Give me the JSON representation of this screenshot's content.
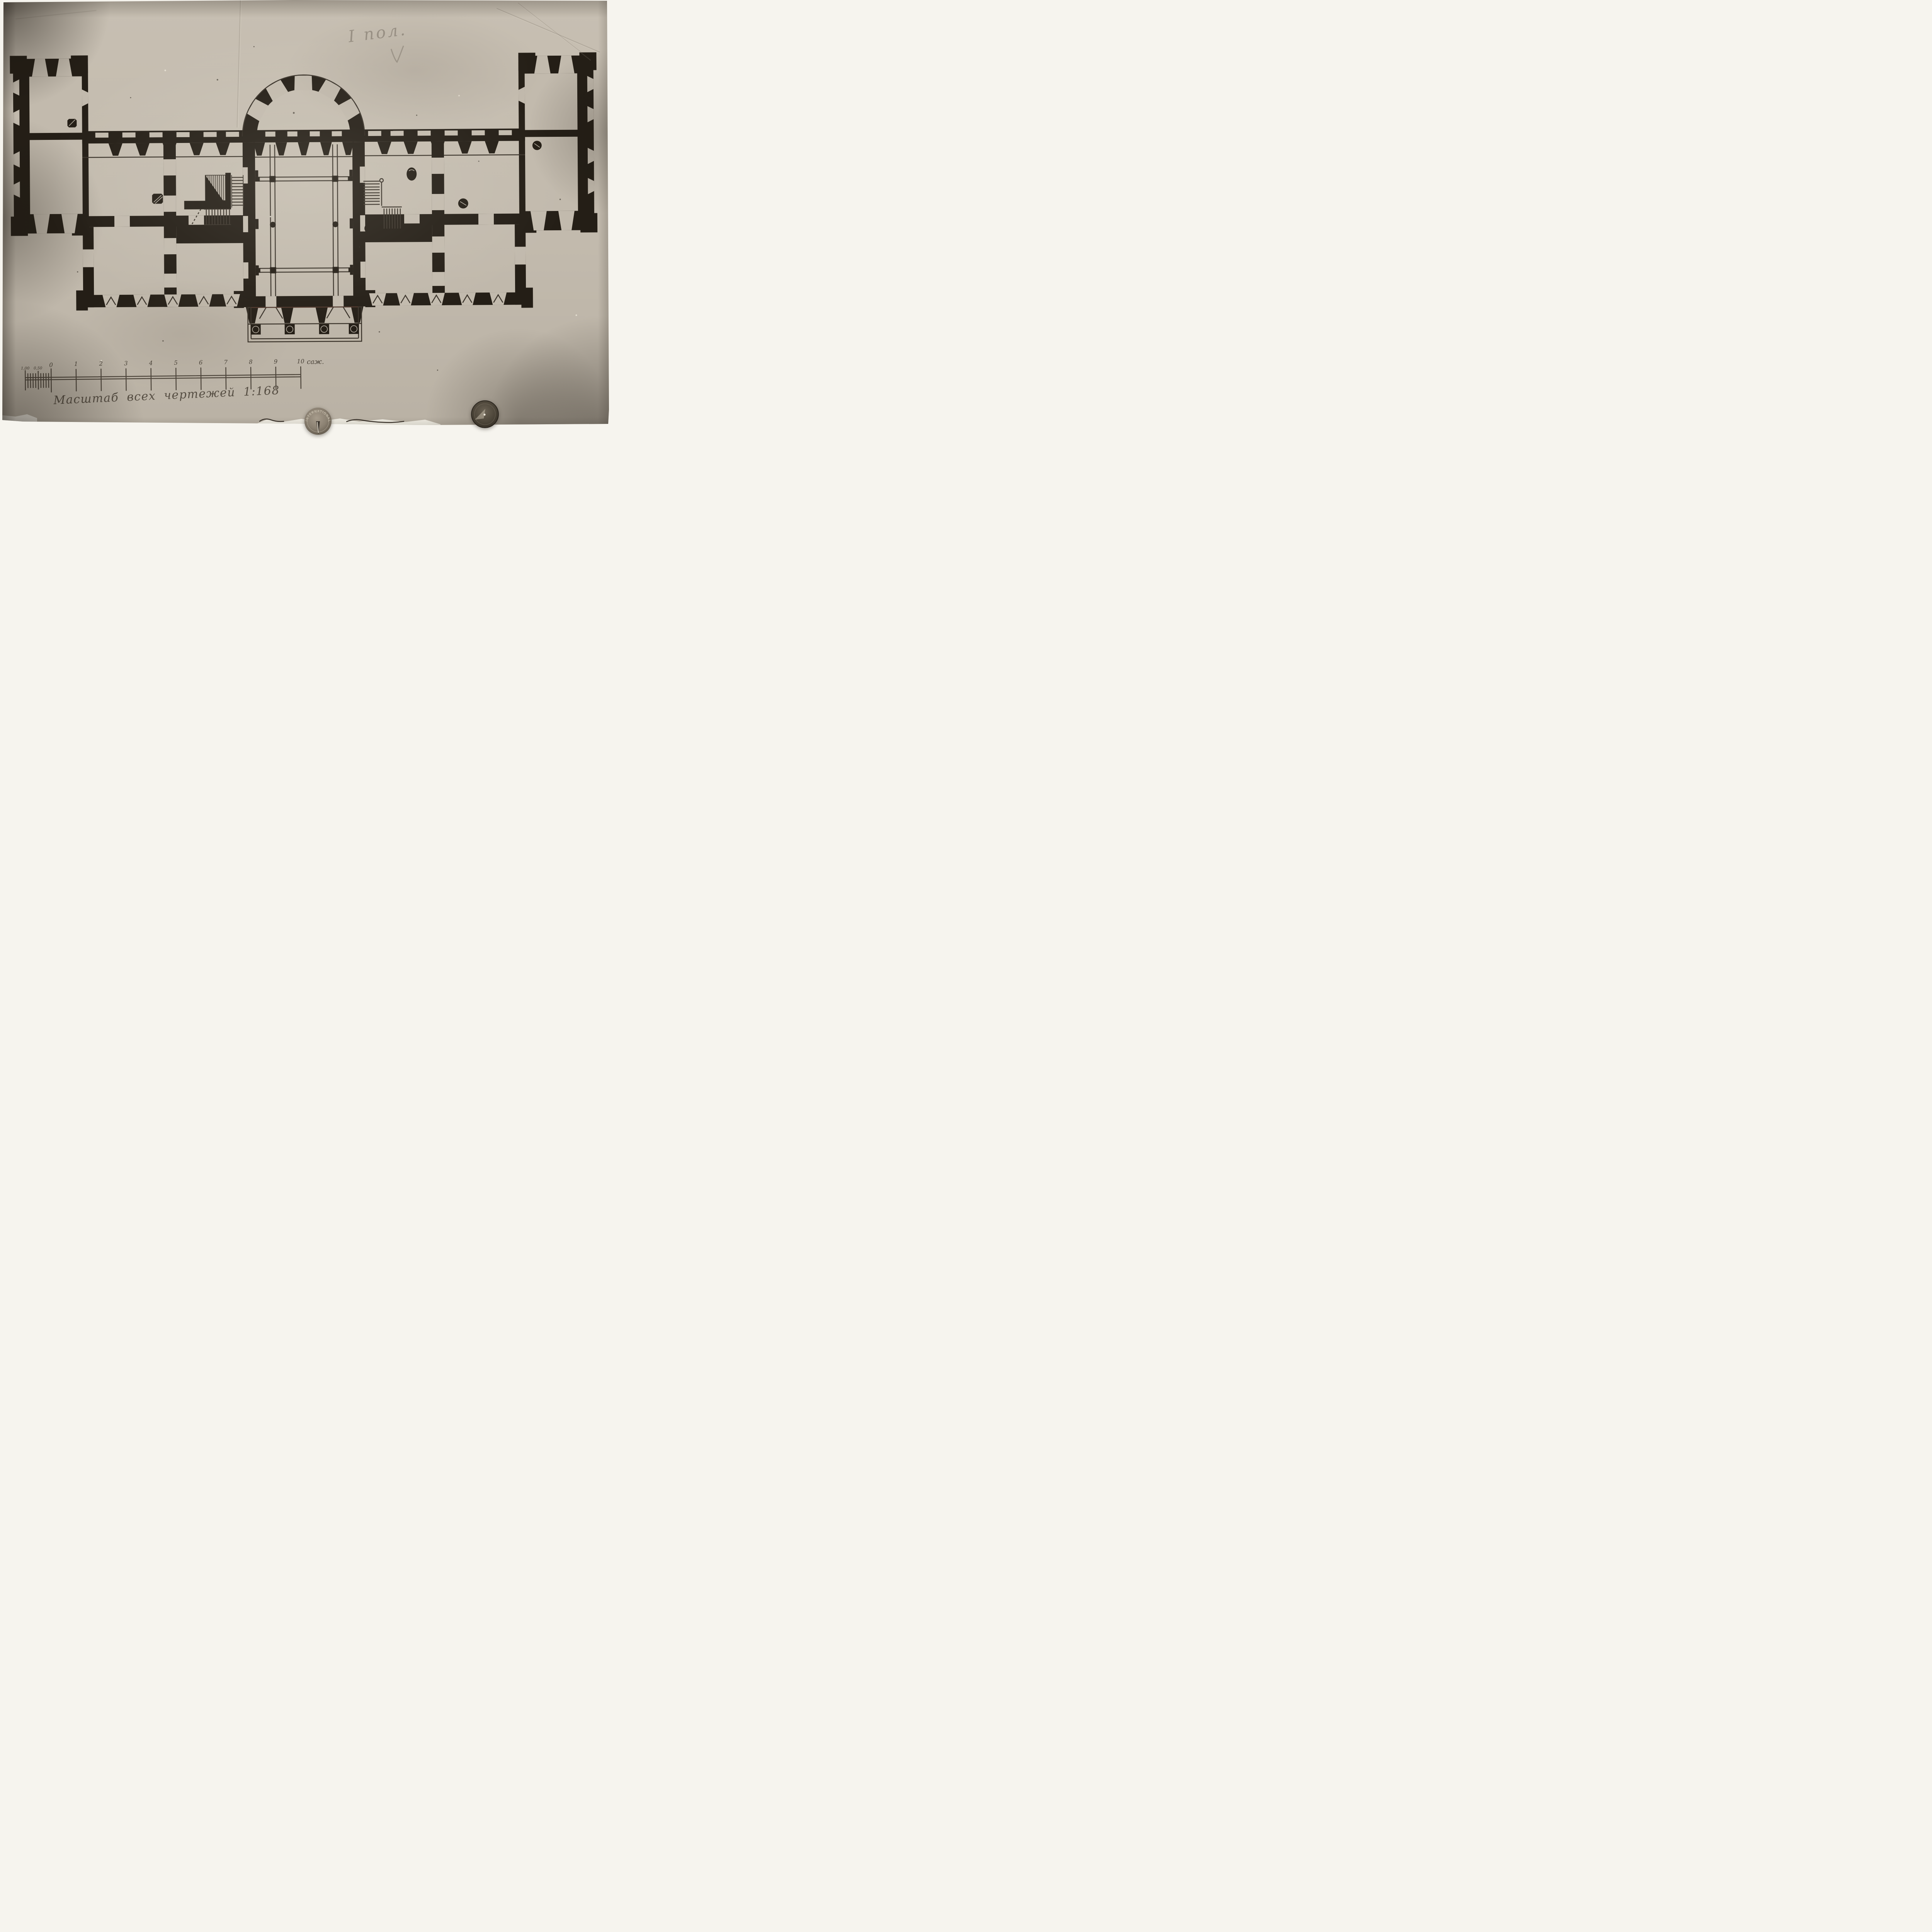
{
  "photo": {
    "kind": "archival photograph of an ink floor plan pinned to a board",
    "colors": {
      "page_background": "#f6f4ee",
      "photo_paper": "#c2baad",
      "plan_ink": "#241e16",
      "scale_ink": "#4c443a",
      "caption_ink": "#564e43",
      "pencil": "#766e63"
    }
  },
  "pencil_note": {
    "text": "I пол."
  },
  "caption": {
    "text": "Масштаб всех чертежей 1:168"
  },
  "scale_bar": {
    "labels": [
      "1,00",
      "0,50",
      "0",
      "1",
      "2",
      "3",
      "4",
      "5",
      "6",
      "7",
      "8",
      "9",
      "10"
    ],
    "unit": "саж."
  },
  "tack": {
    "rim_text": "INTERNATIONAL"
  }
}
